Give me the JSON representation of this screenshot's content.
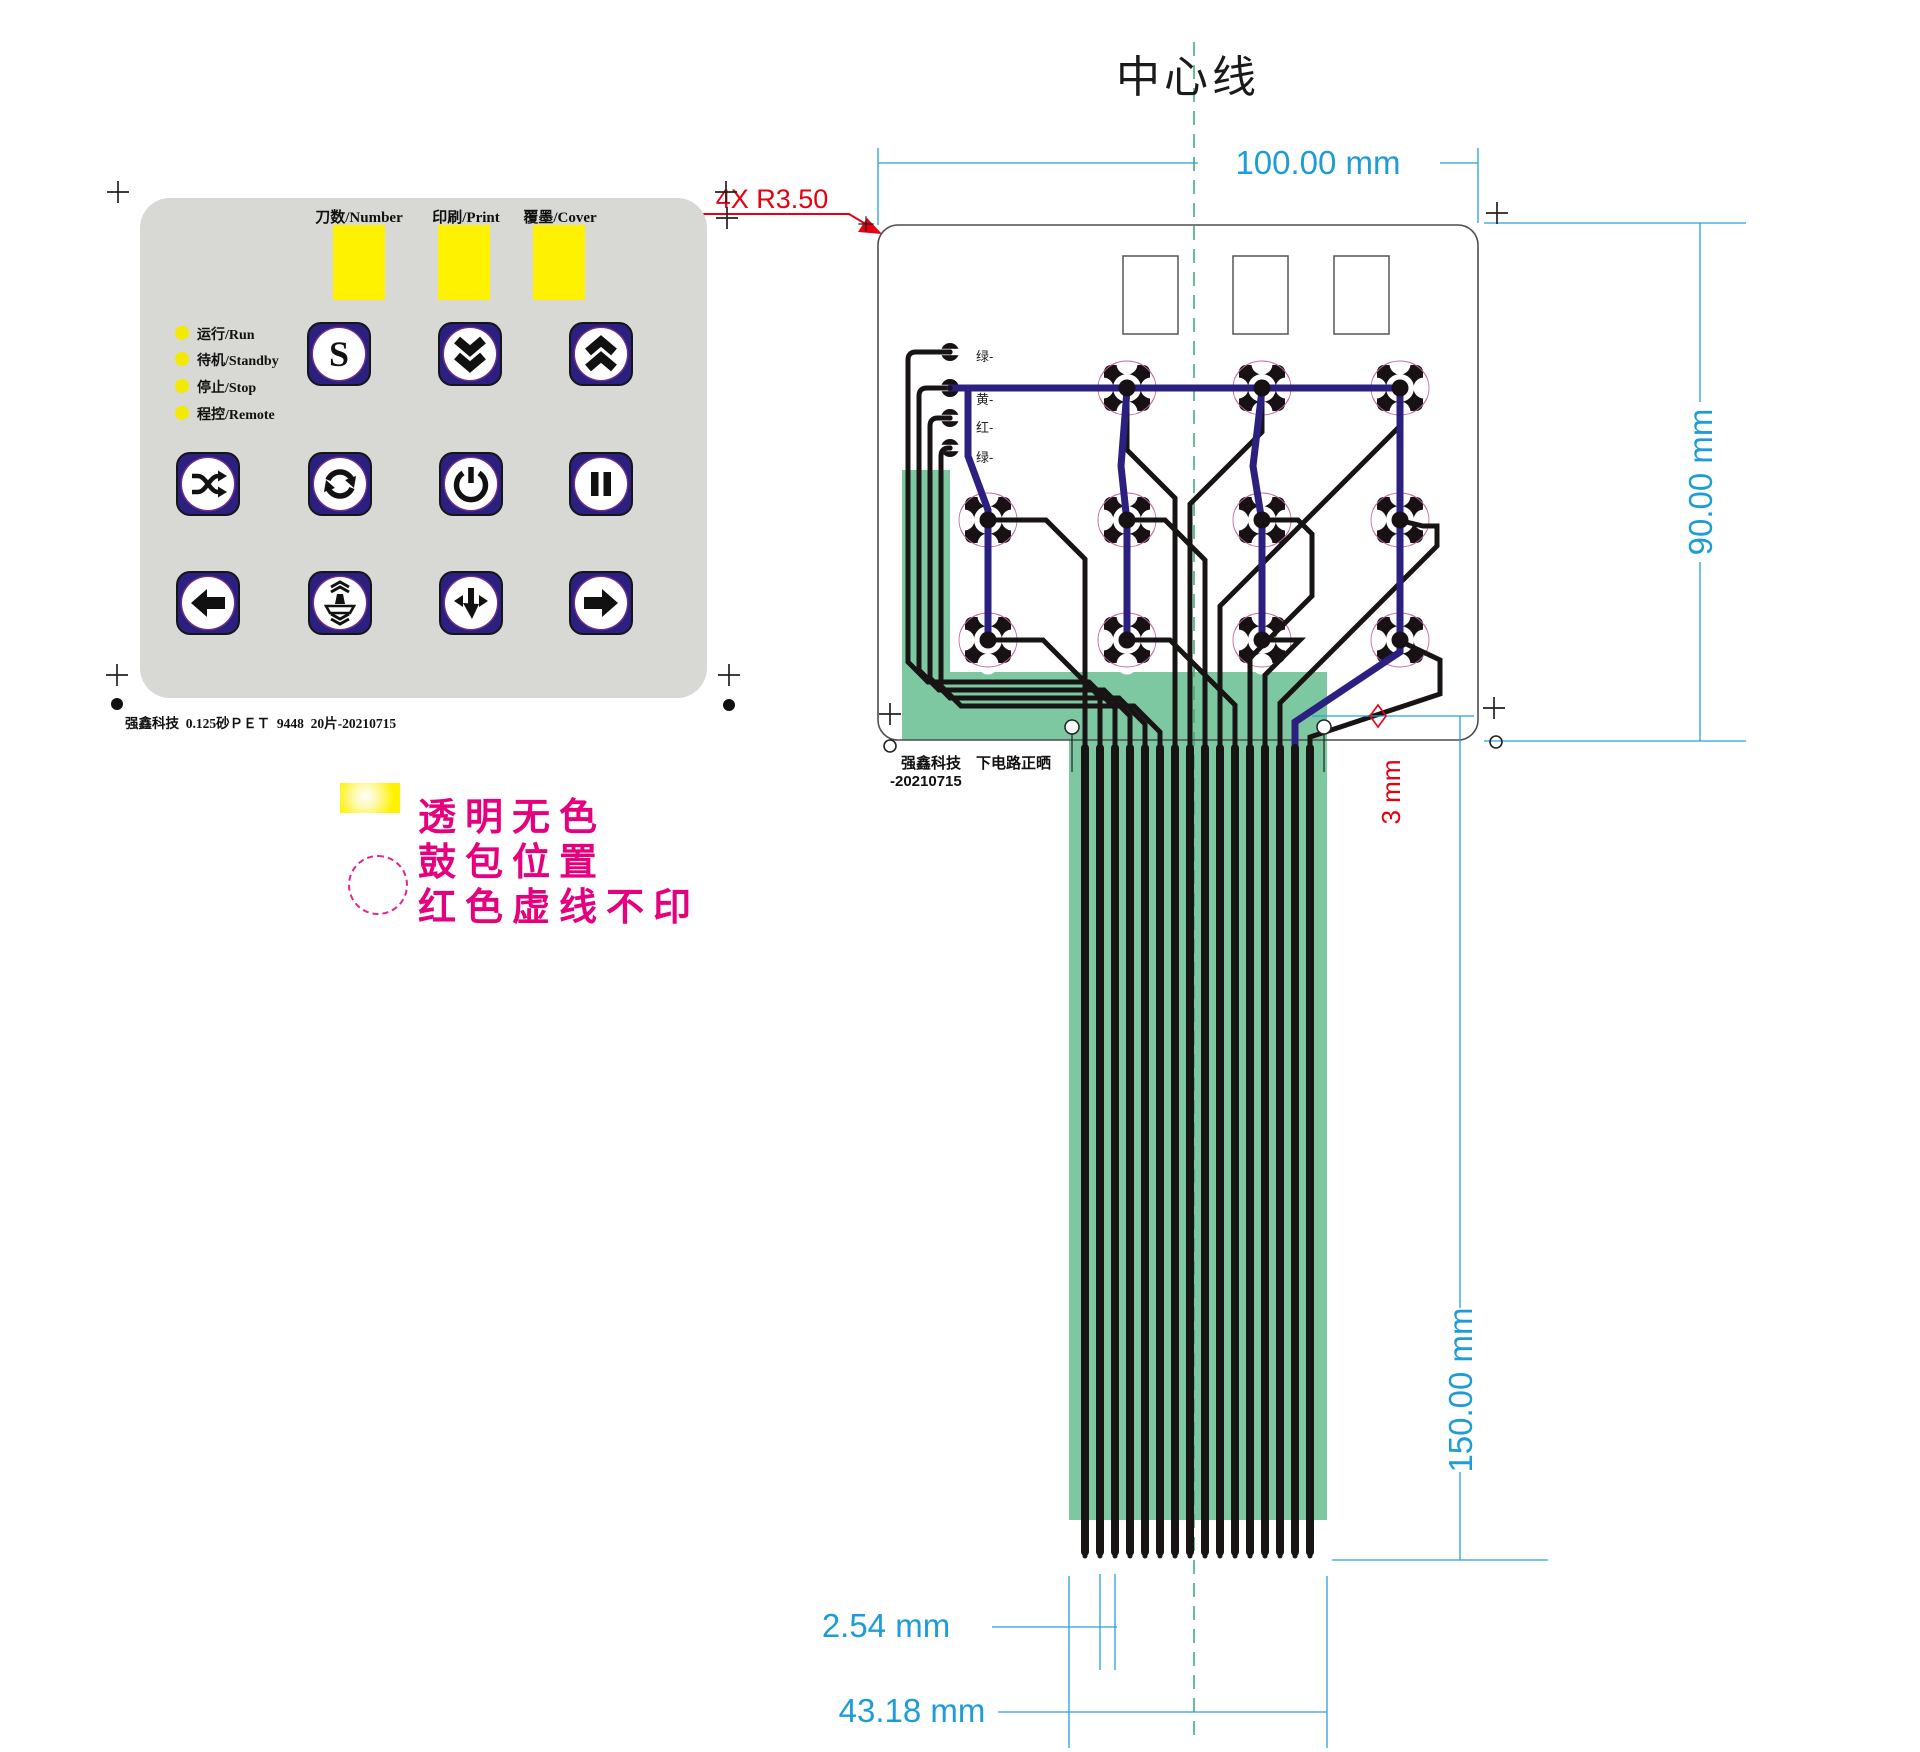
{
  "colors": {
    "panel_gray": "#d8d8d4",
    "button_navy": "#2b2080",
    "window_yellow": "#fff200",
    "legend_magenta": "#e6007e",
    "tail_green": "#7dc8a1",
    "dimension_blue": "#1e9cd8",
    "annotation_red": "#e60012",
    "trace_black": "#191414",
    "trace_blue": "#2b2080",
    "pad_ring_pink": "#d985b5",
    "centerline_green": "#3fae7d"
  },
  "panel": {
    "window_labels": [
      "刀数/Number",
      "印刷/Print",
      "覆墨/Cover"
    ],
    "led_labels": [
      "运行/Run",
      "待机/Standby",
      "停止/Stop",
      "程控/Remote"
    ],
    "s_button": "S",
    "footer": "强鑫科技  0.125砂ＰＥＴ  9448  20片-20210715"
  },
  "legend": {
    "line1": "透明无色",
    "line2": "鼓包位置",
    "line3": "红色虚线不印"
  },
  "diagram": {
    "title": "中心线",
    "corner_note": "4X R3.50",
    "dim_width": "100.00 mm",
    "dim_height": "90.00 mm",
    "dim_tail_length": "150.00 mm",
    "dim_pitch": "2.54 mm",
    "dim_tail_width": "43.18 mm",
    "dim_hole": "3 mm",
    "trace_labels": [
      "绿-",
      "黄-",
      "红-",
      "绿-"
    ],
    "footer_line1": "强鑫科技　下电路正晒",
    "footer_line2": "-20210715"
  }
}
